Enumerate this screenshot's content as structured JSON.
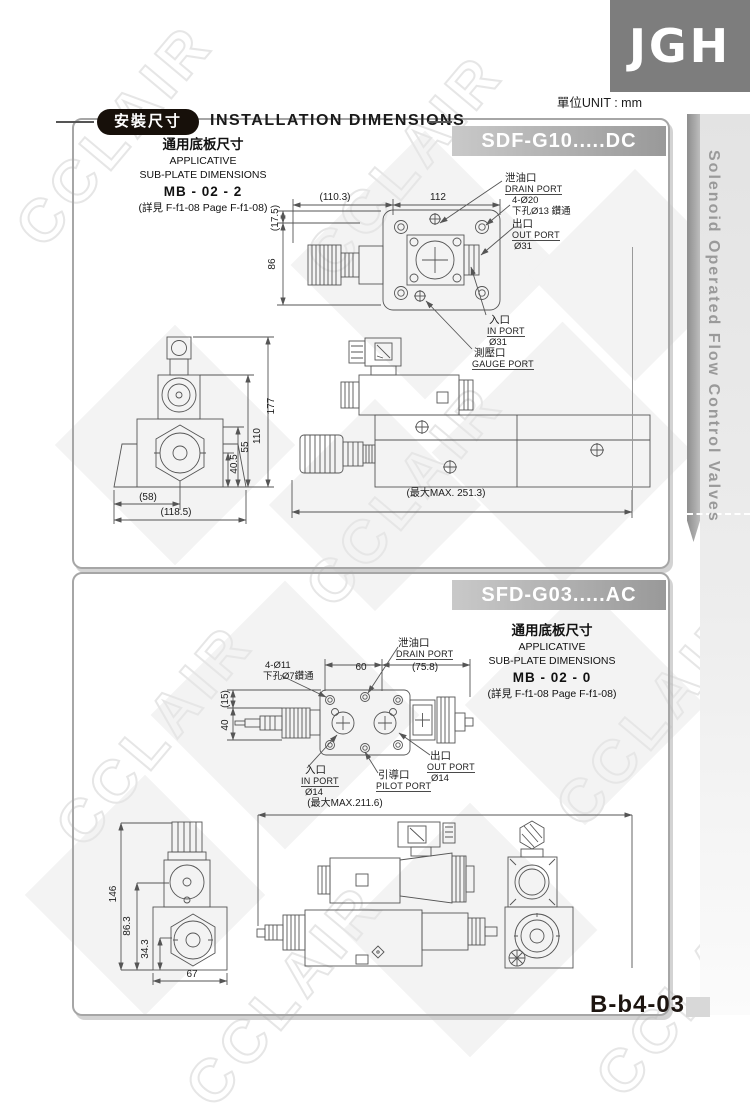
{
  "page": {
    "logo_text": "JGH",
    "unit_label": "單位UNIT : mm",
    "watermark": "CCLAIR",
    "page_number": "B-b4-03",
    "sidebar_title": "Solenoid Operated Flow Control Valves"
  },
  "header": {
    "badge": "安裝尺寸",
    "title": "INSTALLATION DIMENSIONS"
  },
  "panel1": {
    "model": "SDF-G10.....DC",
    "subplate": {
      "title_cn": "通用底板尺寸",
      "line1": "APPLICATIVE",
      "line2": "SUB-PLATE DIMENSIONS",
      "model": "MB - 02 - 2",
      "ref": "(詳見 F-f1-08  Page F-f1-08)"
    },
    "ports": {
      "drain_cn": "泄油口",
      "drain_en": "DRAIN PORT",
      "holes1": "4-Ø20",
      "holes2": "下孔Ø13 鑽通",
      "out_cn": "出口",
      "out_en": "OUT PORT",
      "out_dia": "Ø31",
      "in_cn": "入口",
      "in_en": "IN PORT",
      "in_dia": "Ø31",
      "gauge_cn": "測壓口",
      "gauge_en": "GAUGE PORT"
    },
    "dims": {
      "top_w1": "(110.3)",
      "top_w2": "112",
      "top_h1": "(17.5)",
      "top_h2": "86",
      "front_h1": "177",
      "front_h2": "110",
      "front_h3": "55",
      "front_h4": "40.5",
      "front_w1": "(58)",
      "front_w2": "(118.5)",
      "max_len": "(最大MAX. 251.3)"
    }
  },
  "panel2": {
    "model": "SFD-G03.....AC",
    "subplate": {
      "title_cn": "通用底板尺寸",
      "line1": "APPLICATIVE",
      "line2": "SUB-PLATE DIMENSIONS",
      "model": "MB - 02 - 0",
      "ref": "(詳見 F-f1-08  Page F-f1-08)"
    },
    "ports": {
      "holes1": "4-Ø11",
      "holes2": "下孔Ø7鑽通",
      "drain_cn": "泄油口",
      "drain_en": "DRAIN PORT",
      "in_cn": "入口",
      "in_en": "IN PORT",
      "in_dia": "Ø14",
      "pilot_cn": "引導口",
      "pilot_en": "PILOT PORT",
      "out_cn": "出口",
      "out_en": "OUT PORT",
      "out_dia": "Ø14"
    },
    "dims": {
      "top_w1": "60",
      "top_w2": "(75.8)",
      "top_h1": "(15)",
      "top_h2": "40",
      "front_h1": "146",
      "front_h2": "86.3",
      "front_h3": "34.3",
      "front_w1": "67",
      "max_len": "(最大MAX.211.6)"
    }
  }
}
